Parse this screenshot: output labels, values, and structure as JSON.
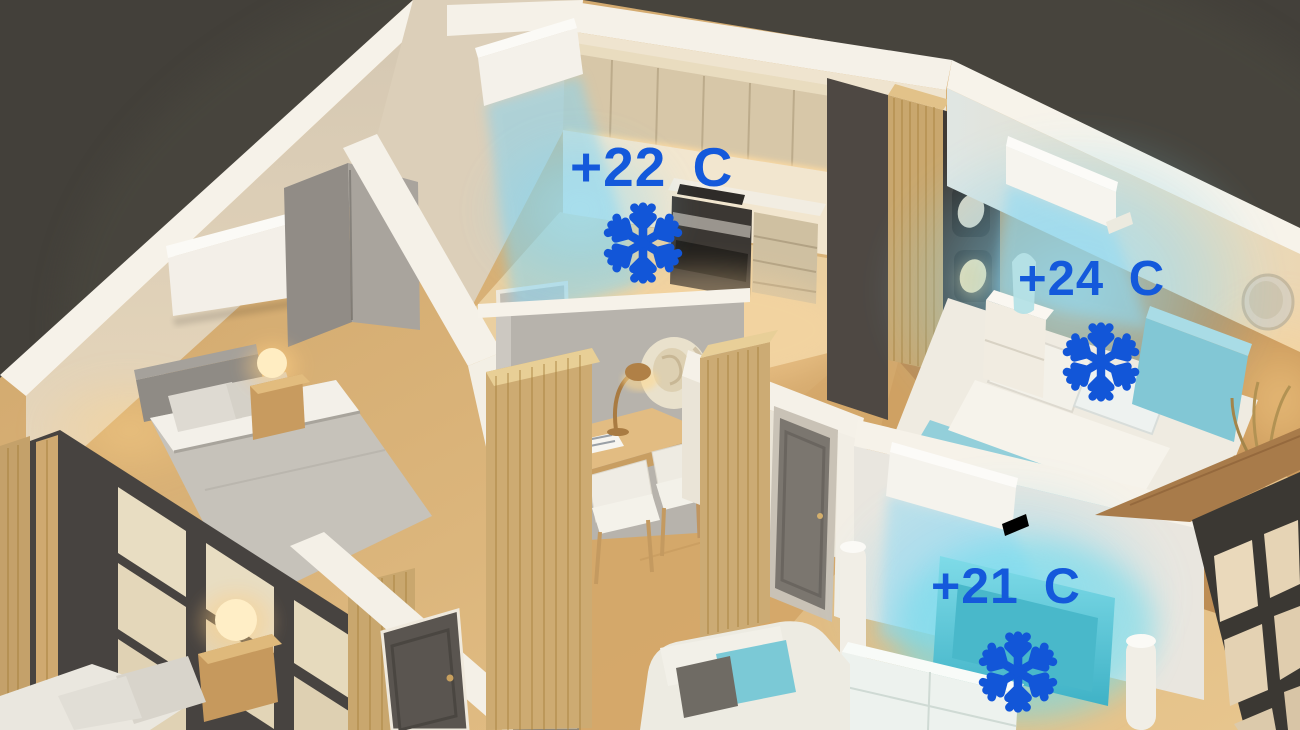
{
  "scene": {
    "background_color": "#43403a",
    "label_blue": "#1459db",
    "snowflake_blue": "#1256d8",
    "cool_glow_color": "#7fd4f0",
    "warm_glow_color": "#ffc87e"
  },
  "annotations": [
    {
      "room": "kitchen",
      "temperature": "+22 C",
      "icon": "snowflake-icon"
    },
    {
      "room": "bedroom",
      "temperature": "+24 C",
      "icon": "snowflake-icon"
    },
    {
      "room": "living-room",
      "temperature": "+21 C",
      "icon": "snowflake-icon"
    }
  ]
}
